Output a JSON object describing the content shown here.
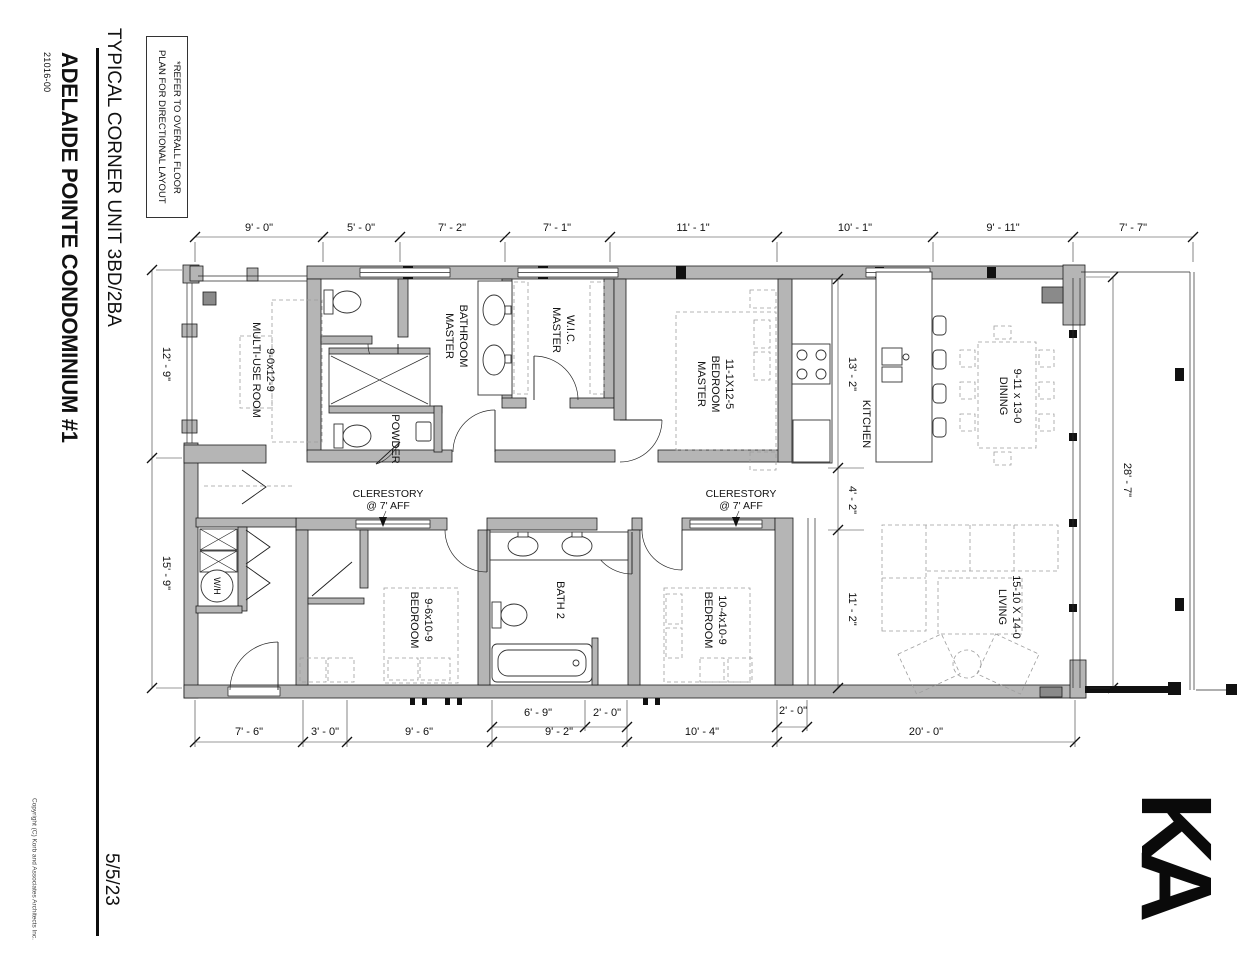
{
  "titleblock": {
    "sheet_title": "TYPICAL CORNER UNIT 3BD/2BA",
    "project_name": "ADELAIDE POINTE CONDOMINIUM #1",
    "project_number": "21016-00",
    "date": "5/5/23",
    "copyright": "Copyright (C) Korb and Associates Architects Inc.",
    "logo": "KA"
  },
  "note": {
    "line1": "*REFER TO OVERALL FLOOR",
    "line2": "PLAN FOR DIRECTIONAL LAYOUT"
  },
  "rooms": {
    "multi_use": [
      "MULTI-USE ROOM",
      "9-0x12-9"
    ],
    "master_bath": [
      "MASTER",
      "BATHROOM"
    ],
    "master_wic": [
      "MASTER",
      "W.I.C."
    ],
    "master_bed": [
      "MASTER",
      "BEDROOM",
      "11-1X12-5"
    ],
    "powder": "POWDER",
    "kitchen": "KITCHEN",
    "dining": [
      "DINING",
      "9-11 x 13-0"
    ],
    "bedroom1": [
      "BEDROOM",
      "9-6x10-9"
    ],
    "bath2": "BATH 2",
    "bedroom2": [
      "BEDROOM",
      "10-4x10-9"
    ],
    "living": [
      "LIVING",
      "15-10 X 14-0"
    ],
    "water_heater": "W/H"
  },
  "annotations": {
    "clerestory": [
      "CLERESTORY",
      "@ 7' AFF"
    ]
  },
  "dims": {
    "top": [
      "9' - 0\"",
      "5' - 0\"",
      "7' - 2\"",
      "7' - 1\"",
      "11' - 1\"",
      "10' - 1\"",
      "9' - 11\"",
      "7' - 7\""
    ],
    "left": [
      "12' - 9\"",
      "15' - 9\""
    ],
    "right": [
      "28' - 7\""
    ],
    "mid": [
      "13' - 2\"",
      "4' - 2\"",
      "11' - 2\""
    ],
    "bottom": [
      "7' - 6\"",
      "3' - 0\"",
      "9' - 6\"",
      "9' - 2\"",
      "10' - 4\"",
      "20' - 0\""
    ],
    "bottom_inner": [
      "6' - 9\"",
      "2' - 0\"",
      "2' - 0\""
    ]
  },
  "colors": {
    "wall_gray": "#b5b5b5",
    "column_gray": "#8a8a8a",
    "ink": "#1a1a1a"
  }
}
